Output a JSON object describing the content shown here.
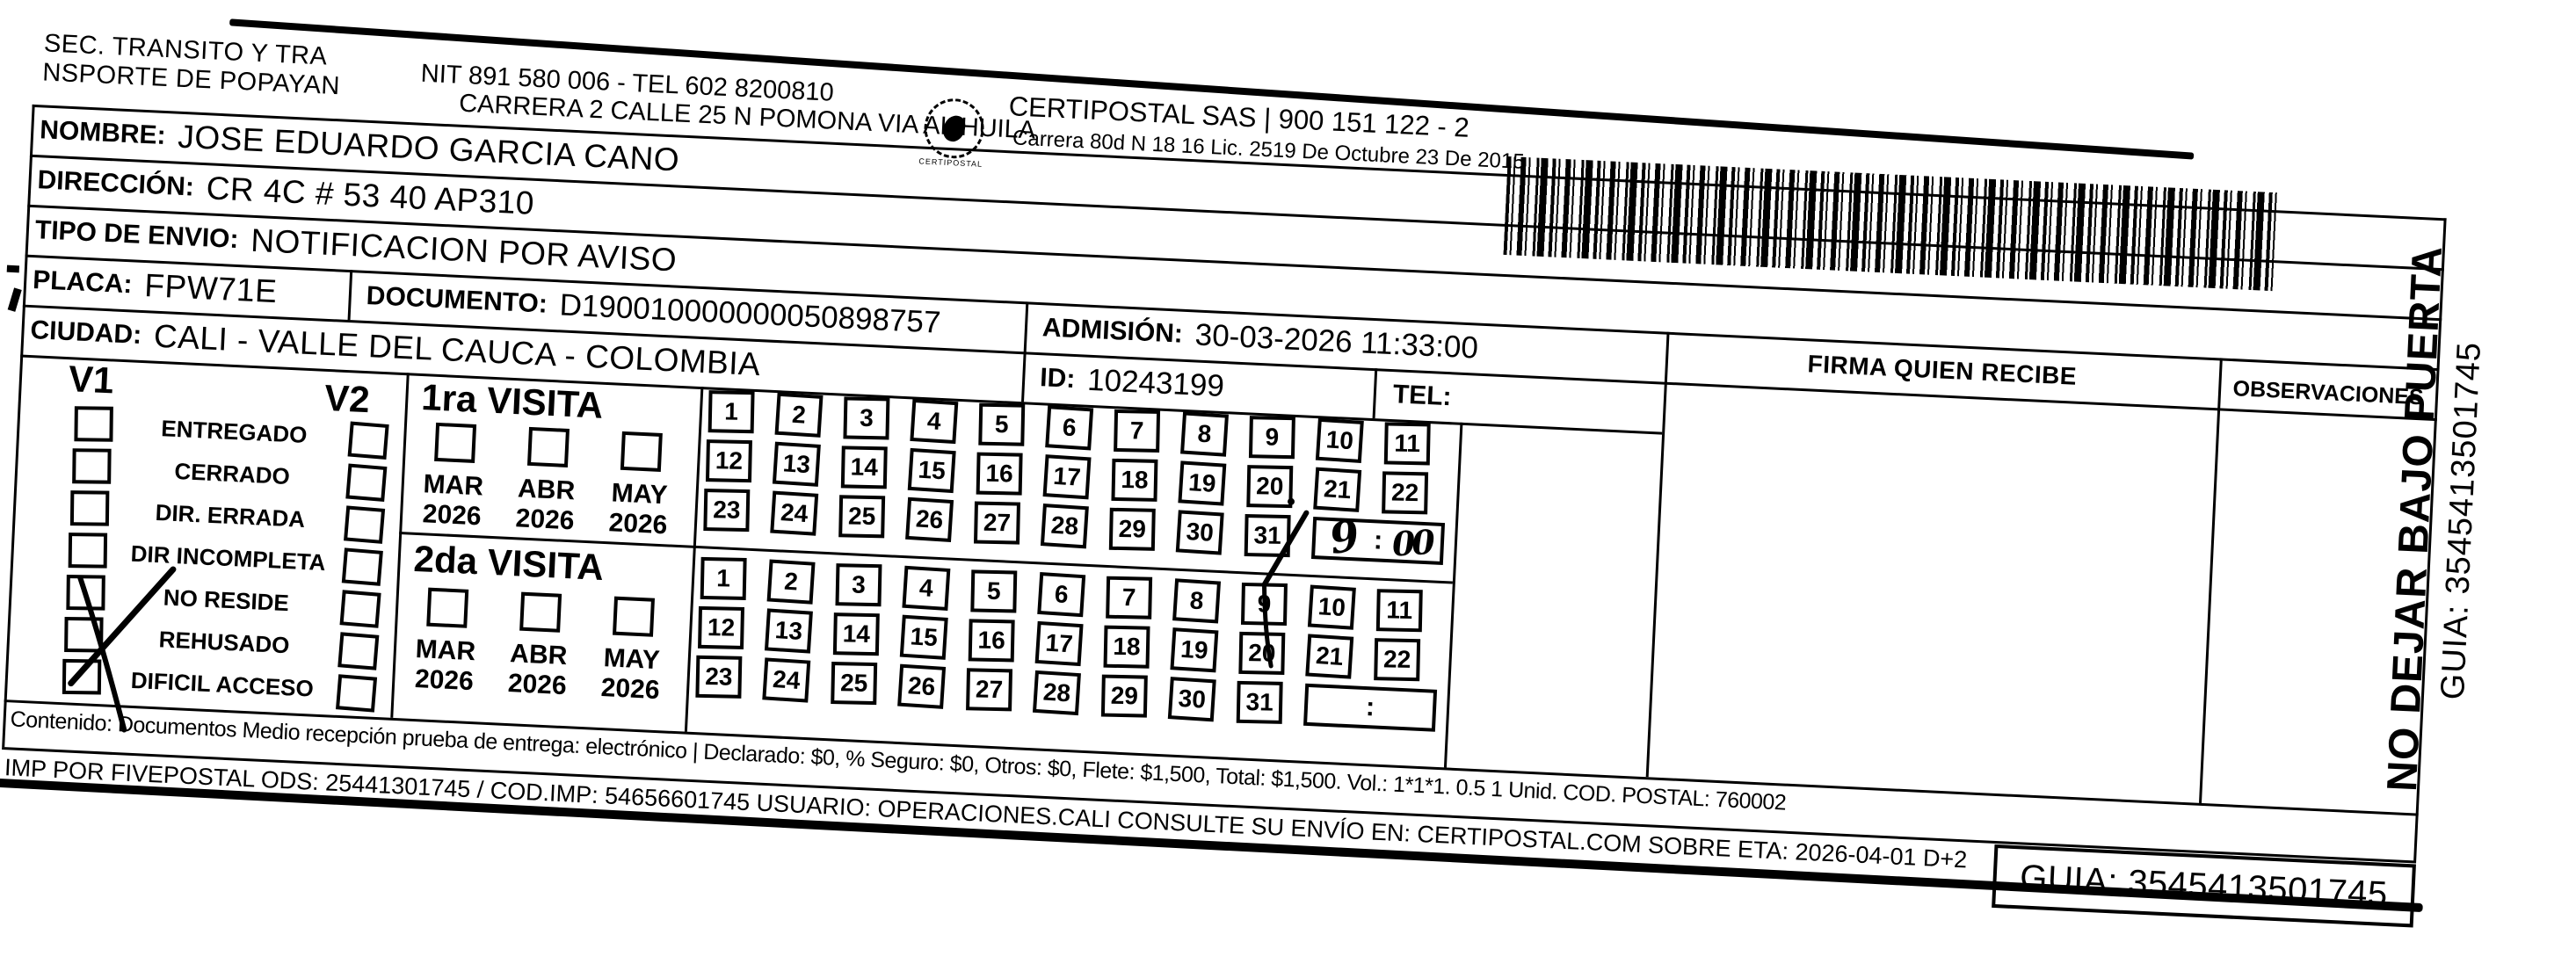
{
  "header": {
    "sender_line1": "SEC. TRANSITO Y TRA",
    "sender_line2": "NSPORTE DE POPAYAN",
    "nit_line": "NIT 891 580 006 - TEL 602 8200810",
    "address_line": "CARRERA 2 CALLE 25 N POMONA VIA AL HUILA",
    "company_line": "CERTIPOSTAL SAS | 900 151 122 - 2",
    "company_sub_line": "Carrera 80d N 18 16  Lic. 2519 De Octubre 23 De 2015",
    "stamp_caption": "CERTIPOSTAL"
  },
  "shipment": {
    "nombre_label": "NOMBRE:",
    "nombre_value": "JOSE EDUARDO GARCIA CANO",
    "direccion_label": "DIRECCIÓN:",
    "direccion_value": "CR 4C # 53 40 AP310",
    "tipo_envio_label": "TIPO DE ENVIO:",
    "tipo_envio_value": "NOTIFICACION POR AVISO",
    "placa_label": "PLACA:",
    "placa_value": "FPW71E",
    "documento_label": "DOCUMENTO:",
    "documento_value": "D190010000000050898757",
    "ciudad_label": "CIUDAD:",
    "ciudad_value": "CALI - VALLE DEL CAUCA - COLOMBIA",
    "admision_label": "ADMISIÓN:",
    "admision_value": "30-03-2026 11:33:00",
    "id_label": "ID:",
    "id_value": "10243199",
    "tel_label": "TEL:",
    "tel_value": ""
  },
  "visits": {
    "v1_label": "V1",
    "v2_label": "V2",
    "statuses": [
      "ENTREGADO",
      "CERRADO",
      "DIR. ERRADA",
      "DIR INCOMPLETA",
      "NO RESIDE",
      "REHUSADO",
      "DIFICIL ACCESO"
    ],
    "checked_status_index": 4,
    "checked_status": "NO RESIDE",
    "first_visit_title": "1ra VISITA",
    "second_visit_title": "2da VISITA",
    "months": [
      "MAR",
      "ABR",
      "MAY"
    ],
    "year": "2026",
    "first_visit_marked_day": "31",
    "first_visit_handwritten_time": "9:00"
  },
  "calendar": {
    "days": [
      1,
      2,
      3,
      4,
      5,
      6,
      7,
      8,
      9,
      10,
      11,
      12,
      13,
      14,
      15,
      16,
      17,
      18,
      19,
      20,
      21,
      22,
      23,
      24,
      25,
      26,
      27,
      28,
      29,
      30,
      31
    ],
    "time_colon": ":"
  },
  "signature": {
    "firma_header": "FIRMA QUIEN RECIBE",
    "observaciones_header": "OBSERVACIONES"
  },
  "side_label": {
    "line1": "NO DEJAR BAJO PUERTA",
    "line2": "GUIA: 3545413501745"
  },
  "footer": {
    "contenido_line": "Contenido: Documentos Medio recepción prueba de entrega: electrónico | Declarado: $0, % Seguro: $0, Otros: $0, Flete: $1,500, Total: $1,500. Vol.: 1*1*1. 0.5  1 Unid. COD. POSTAL: 760002",
    "imp_line": "IMP POR FIVEPOSTAL ODS: 25441301745 / COD.IMP: 54656601745 USUARIO: OPERACIONES.CALI CONSULTE SU ENVÍO EN: CERTIPOSTAL.COM SOBRE ETA: 2026-04-01 D+2",
    "guia_label": "GUIA: 3545413501745"
  },
  "icons": {
    "barcode": "barcode",
    "stamp": "certipostal-seal"
  },
  "colors": {
    "ink": "#000000",
    "paper": "#ffffff"
  }
}
